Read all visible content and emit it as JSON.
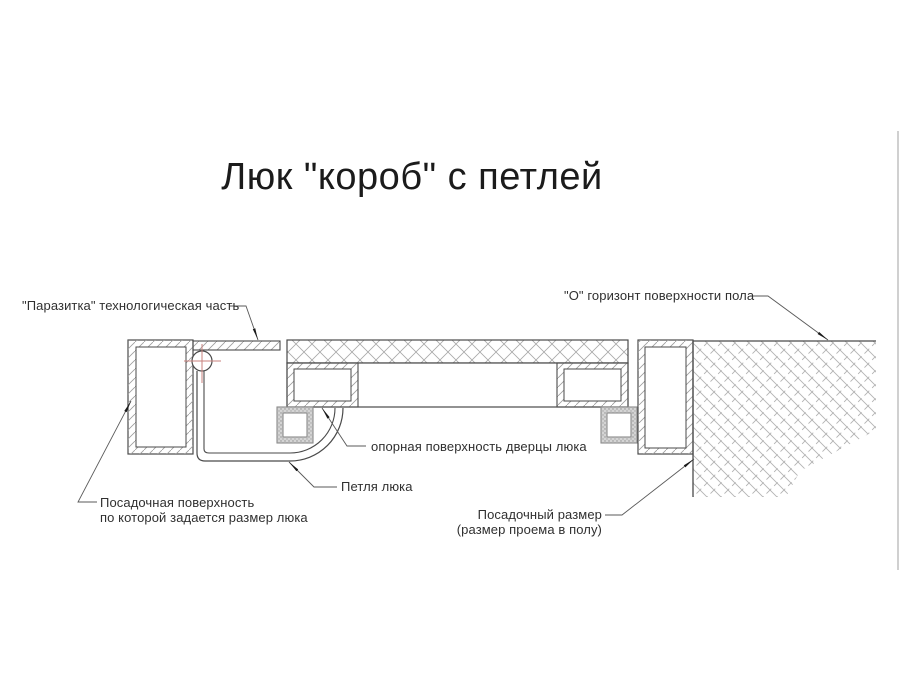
{
  "title": "Люк \"короб\" с петлей",
  "labels": {
    "parasitka": "\"Паразитка\" технологическая часть",
    "floor_horizon": "\"О\" горизонт поверхности пола",
    "support_surface": "опорная поверхность дверцы люка",
    "hinge": "Петля люка",
    "seating_surface_line1": "Посадочная поверхность",
    "seating_surface_line2": "по которой задается размер люка",
    "seating_size_line1": "Посадочный размер",
    "seating_size_line2": "(размер проема в полу)"
  },
  "colors": {
    "line": "#4a4a4a",
    "leader": "#5a5a5a",
    "arrow": "#1a1a1a",
    "hatch": "#9c9c9c",
    "floor_hatch": "#b2b2b2",
    "center_mark_red": "#c9827e",
    "seal_stipple": "#d4d4d4",
    "text": "#303030",
    "image_edge": "#bcbcbc",
    "background": "#ffffff"
  }
}
